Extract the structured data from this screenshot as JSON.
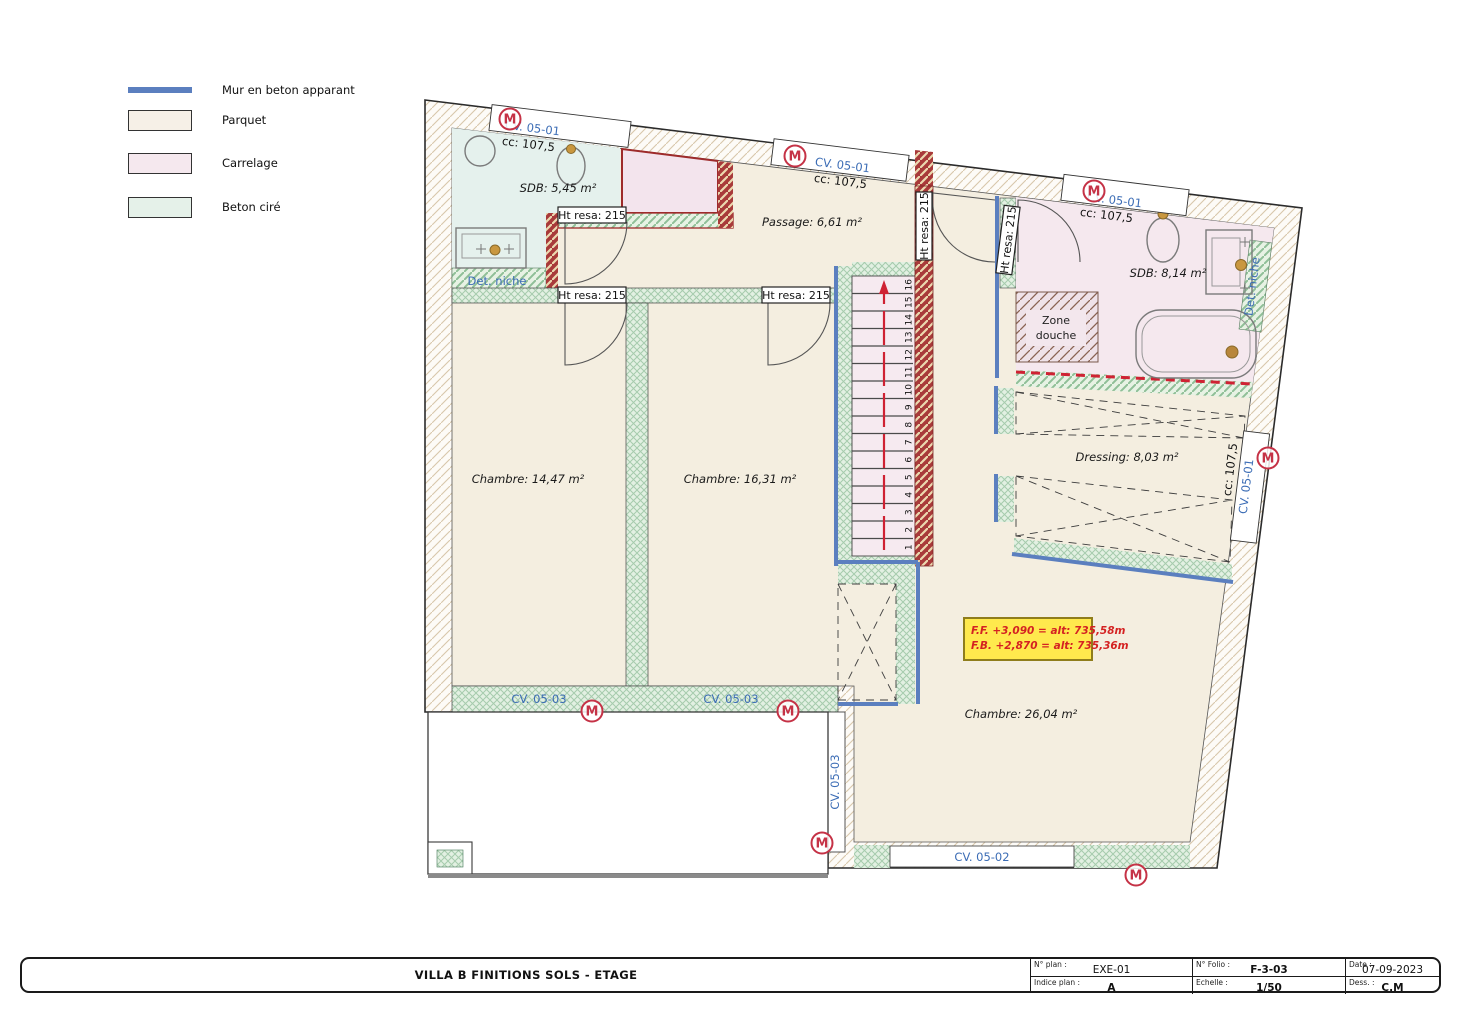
{
  "legend": {
    "items": [
      {
        "label": "Mur en beton apparant",
        "color": "#5b7fbf",
        "type": "line"
      },
      {
        "label": "Parquet",
        "color": "#f6f0e7",
        "type": "swatch"
      },
      {
        "label": "Carrelage",
        "color": "#f5e8ee",
        "type": "swatch"
      },
      {
        "label": "Beton ciré",
        "color": "#e5f1e9",
        "type": "swatch"
      }
    ]
  },
  "plan": {
    "rooms": {
      "sdb1": "SDB: 5,45 m²",
      "passage": "Passage: 6,61 m²",
      "sdb2": "SDB: 8,14 m²",
      "chambre1": "Chambre: 14,47 m²",
      "chambre2": "Chambre: 16,31 m²",
      "dressing": "Dressing: 8,03 m²",
      "chambre3": "Chambre: 26,04 m²",
      "zone_douche_l1": "Zone",
      "zone_douche_l2": "douche"
    },
    "labels": {
      "cv_05_01": "CV. 05-01",
      "cv_05_02": "CV. 05-02",
      "cv_05_03": "CV. 05-03",
      "cc_107_5": "cc: 107,5",
      "ht_resa": "Ht resa: 215",
      "det_niche": "Det. niche",
      "marker_m": "M"
    },
    "altitude": {
      "line1": "F.F. +3,090 = alt: 735,58m",
      "line2": "F.B. +2,870 = alt: 735,36m"
    }
  },
  "stairs": {
    "steps": [
      "1",
      "2",
      "3",
      "4",
      "5",
      "6",
      "7",
      "8",
      "9",
      "10",
      "11",
      "12",
      "13",
      "14",
      "15",
      "16"
    ]
  },
  "footer": {
    "title": "VILLA B FINITIONS SOLS  - ETAGE",
    "cells": [
      {
        "label": "N° plan :",
        "value": "EXE-01"
      },
      {
        "label": "N° Folio :",
        "value": "F-3-03"
      },
      {
        "label": "Date :",
        "value": "07-09-2023"
      },
      {
        "label": "Indice plan :",
        "value": "A"
      },
      {
        "label": "Echelle :",
        "value": "1/50"
      },
      {
        "label": "Dess. :",
        "value": "C.M"
      }
    ]
  }
}
